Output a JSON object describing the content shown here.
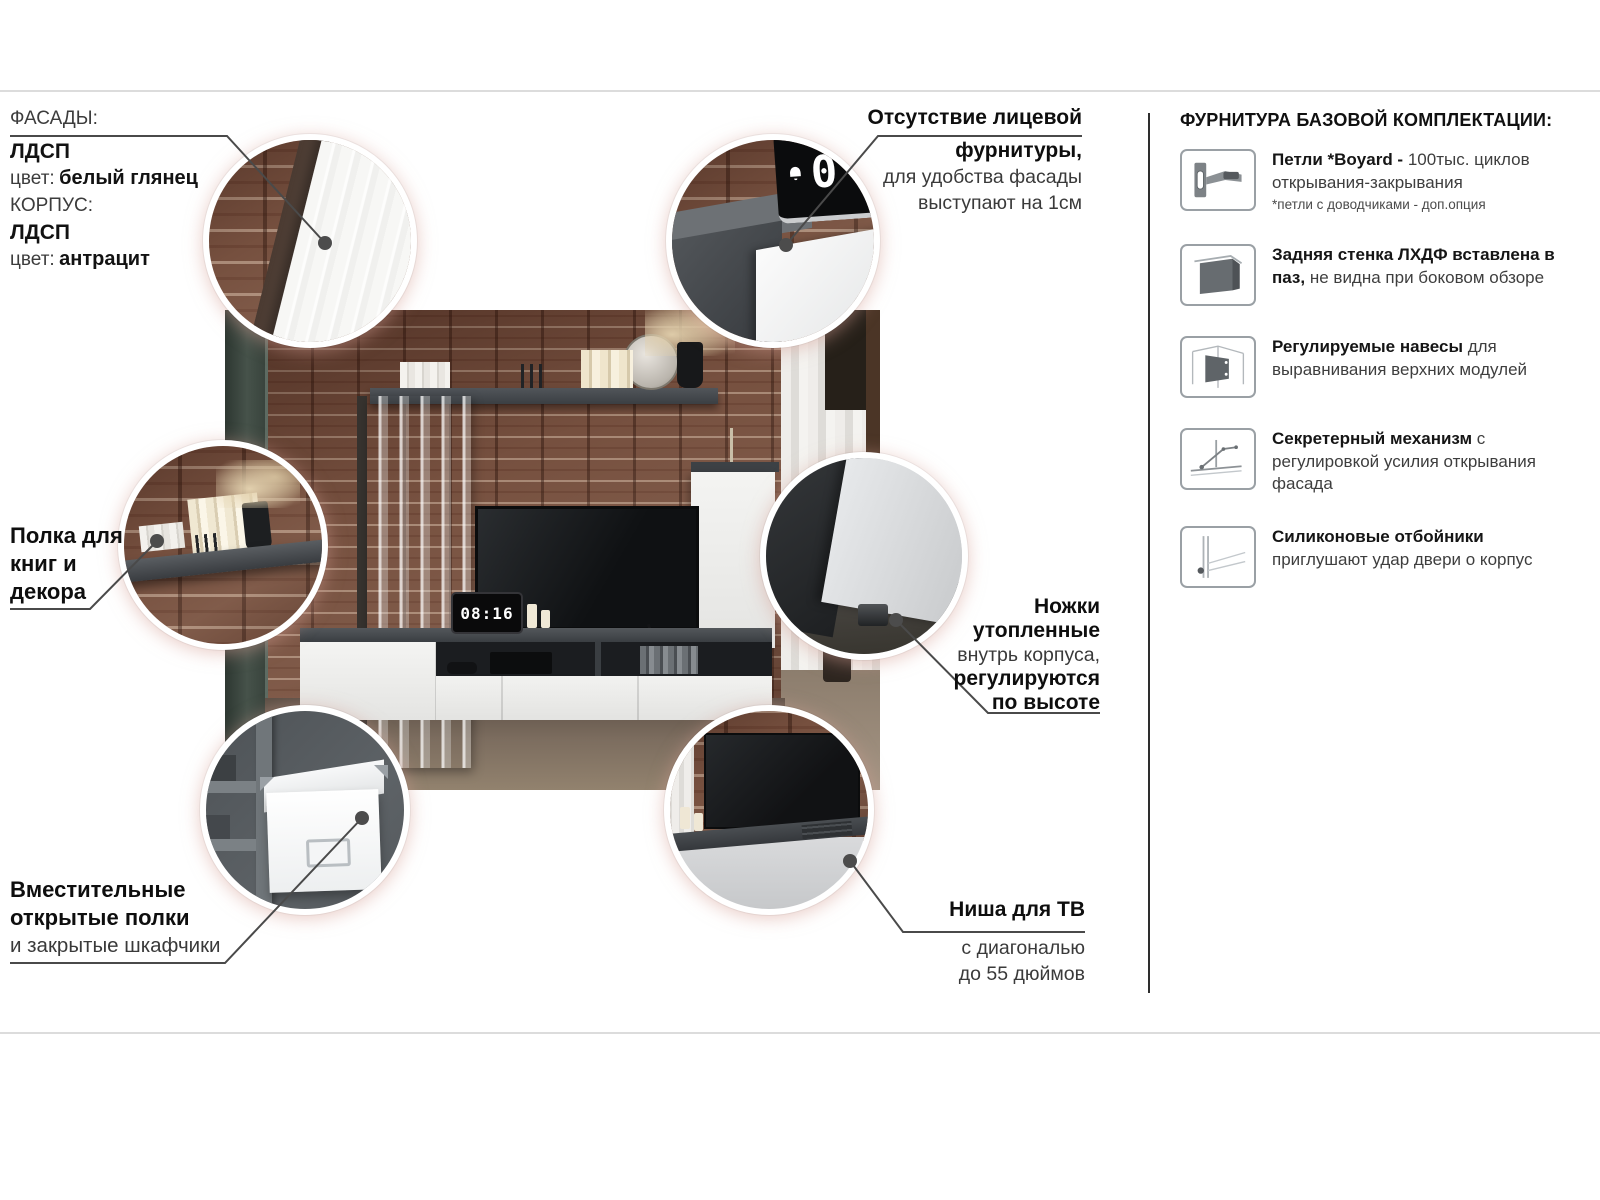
{
  "materials": {
    "facades_label": "ФАСАДЫ:",
    "facades_material": "ЛДСП",
    "color_label_1": "цвет:",
    "facades_color": "белый глянец",
    "body_label": "КОРПУС:",
    "body_material": "ЛДСП",
    "color_label_2": "цвет:",
    "body_color": "антрацит"
  },
  "callouts": {
    "front_hardware": {
      "line1": "Отсутствие лицевой",
      "line2": "фурнитуры,",
      "line3": "для удобства фасады",
      "line4": "выступают на 1см"
    },
    "book_shelf": {
      "line1": "Полка для",
      "line2": "книг и",
      "line3": "декора"
    },
    "legs": {
      "line1": "Ножки",
      "line2": "утопленные",
      "line3": "внутрь корпуса,",
      "line4": "регулируются",
      "line5": "по высоте"
    },
    "storage": {
      "line1": "Вместительные",
      "line2": "открытые полки",
      "line3": "и закрытые шкафчики"
    },
    "tv_niche": {
      "line1": "Ниша для ТВ",
      "line2": "с диагональю",
      "line3": "до 55 дюймов"
    }
  },
  "hardware_panel": {
    "title": "ФУРНИТУРА БАЗОВОЙ КОМПЛЕКТАЦИИ:",
    "items": [
      {
        "icon": "hinge-icon",
        "name": "Петли *Boyard -",
        "description": "100тыс. циклов открывания-закрывания",
        "note": "*петли с доводчиками - доп.опция"
      },
      {
        "icon": "back-panel-icon",
        "name": "Задняя стенка ЛХДФ вставлена в паз,",
        "description": "не видна при боковом обзоре",
        "note": ""
      },
      {
        "icon": "cabinet-hanger-icon",
        "name": "Регулируемые навесы",
        "description": "для выравнивания верхних модулей",
        "note": ""
      },
      {
        "icon": "flap-mechanism-icon",
        "name": "Секретерный механизм",
        "description": "с регулировкой усилия открывания фасада",
        "note": ""
      },
      {
        "icon": "silicone-bumper-icon",
        "name": "Силиконовые отбойники",
        "description": "приглушают удар двери о корпус",
        "note": ""
      }
    ]
  },
  "photo": {
    "clock_time": "08:16"
  },
  "colors": {
    "callout_line": "#4a4a4a",
    "divider": "#dcdcdc",
    "vertical_rule": "#2e2e2e",
    "brick": "#76503f",
    "anthracite": "#45494d",
    "white_gloss": "#f2f2f0",
    "rim_glow": "#e9cfc9"
  }
}
